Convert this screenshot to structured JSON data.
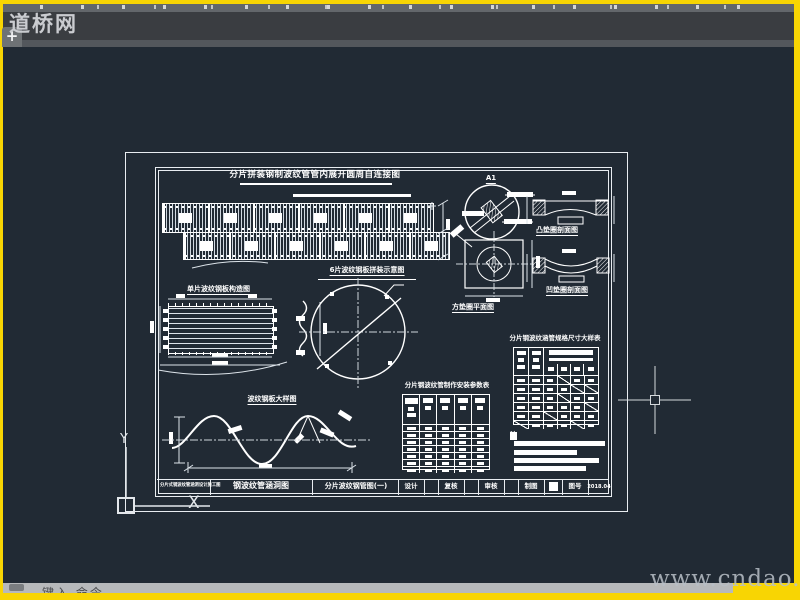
{
  "window": {
    "plus_tab": "+",
    "watermark_top": "道桥网",
    "watermark_bottom": "www.cndao.com",
    "command_hint": "键入 命令"
  },
  "ucs": {
    "x": "X",
    "y": "Y"
  },
  "drawing": {
    "main_title": "分片拼装钢制波纹管管内展开圆周自连接图",
    "plate_title": "单片波纹钢板构造图",
    "assembly_title": "6片波纹钢板拼装示意图",
    "wave_title": "波纹钢板大样图",
    "a1_label": "A1",
    "square_washer_title": "方垫圈平面图",
    "convex_washer_title": "凸垫圈剖面图",
    "concave_washer_title": "凹垫圈剖面图",
    "notes_label": "注",
    "mid_table": {
      "title": "分片钢波纹管制作安装参数表",
      "cols": 5,
      "rows": 7
    },
    "right_table": {
      "title": "分片钢波纹涵管规格尺寸大样表",
      "cols": 6,
      "rows": 6,
      "slash_cells": [
        [
          0,
          3
        ],
        [
          1,
          4
        ],
        [
          1,
          5
        ],
        [
          2,
          3
        ],
        [
          3,
          5
        ],
        [
          4,
          2
        ],
        [
          5,
          4
        ],
        [
          5,
          0
        ]
      ]
    },
    "title_block": {
      "project": "分片式钢波纹管涵洞设计施工图",
      "set_name": "钢波纹管涵洞图",
      "sheet_name": "分片波纹钢管图(一)",
      "f1": "设计",
      "f2": "复核",
      "f3": "审核",
      "f4": "制图",
      "f5": "图号",
      "date": "2018.04"
    }
  }
}
